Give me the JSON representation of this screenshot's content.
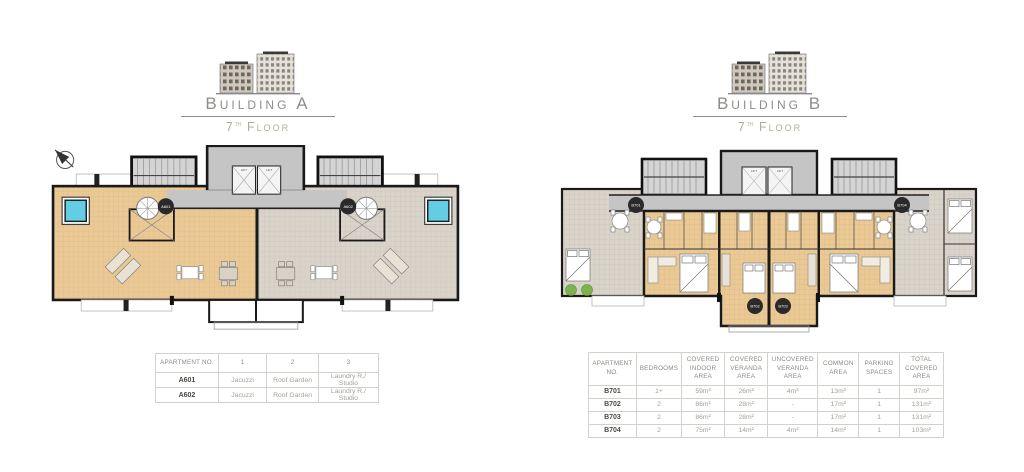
{
  "building_a": {
    "title": "Building A",
    "floor_number": "7",
    "floor_suffix": "th",
    "floor_word": "Floor",
    "plan": {
      "badges": [
        "A601",
        "A602"
      ],
      "lift_label": "LIFT"
    },
    "table": {
      "headers": [
        "Apartment No.",
        "1",
        "2",
        "3"
      ],
      "rows": [
        [
          "A601",
          "Jacuzzi",
          "Roof Garden",
          "Laundry R./ Studio"
        ],
        [
          "A602",
          "Jacuzzi",
          "Roof Garden",
          "Laundry R./ Studio"
        ]
      ]
    }
  },
  "building_b": {
    "title": "Building B",
    "floor_number": "7",
    "floor_suffix": "th",
    "floor_word": "Floor",
    "plan": {
      "badges": [
        "B701",
        "B702",
        "B703",
        "B704"
      ],
      "lift_label": "LIFT"
    },
    "table": {
      "headers": [
        "Apartment No.",
        "Bedrooms",
        "Covered Indoor Area",
        "Covered Veranda Area",
        "Uncovered Veranda Area",
        "Common Area",
        "Parking Spaces",
        "Total Covered Area"
      ],
      "rows": [
        [
          "B701",
          "1+",
          "59m²",
          "26m²",
          "4m²",
          "13m²",
          "1",
          "97m²"
        ],
        [
          "B702",
          "2",
          "86m²",
          "28m²",
          "-",
          "17m²",
          "1",
          "131m²"
        ],
        [
          "B703",
          "2",
          "86m²",
          "28m²",
          "-",
          "17m²",
          "1",
          "131m²"
        ],
        [
          "B704",
          "2",
          "75m²",
          "14m²",
          "4m²",
          "14m²",
          "1",
          "103m²"
        ]
      ]
    }
  },
  "colors": {
    "tan_area": "#ebc995",
    "gray_area": "#d9d3c9",
    "core_gray": "#c5c5c5",
    "wall": "#1a1a1a",
    "pool": "#62cde3",
    "plants_green": "#7fb24d",
    "badge": "#2a2a2a"
  }
}
